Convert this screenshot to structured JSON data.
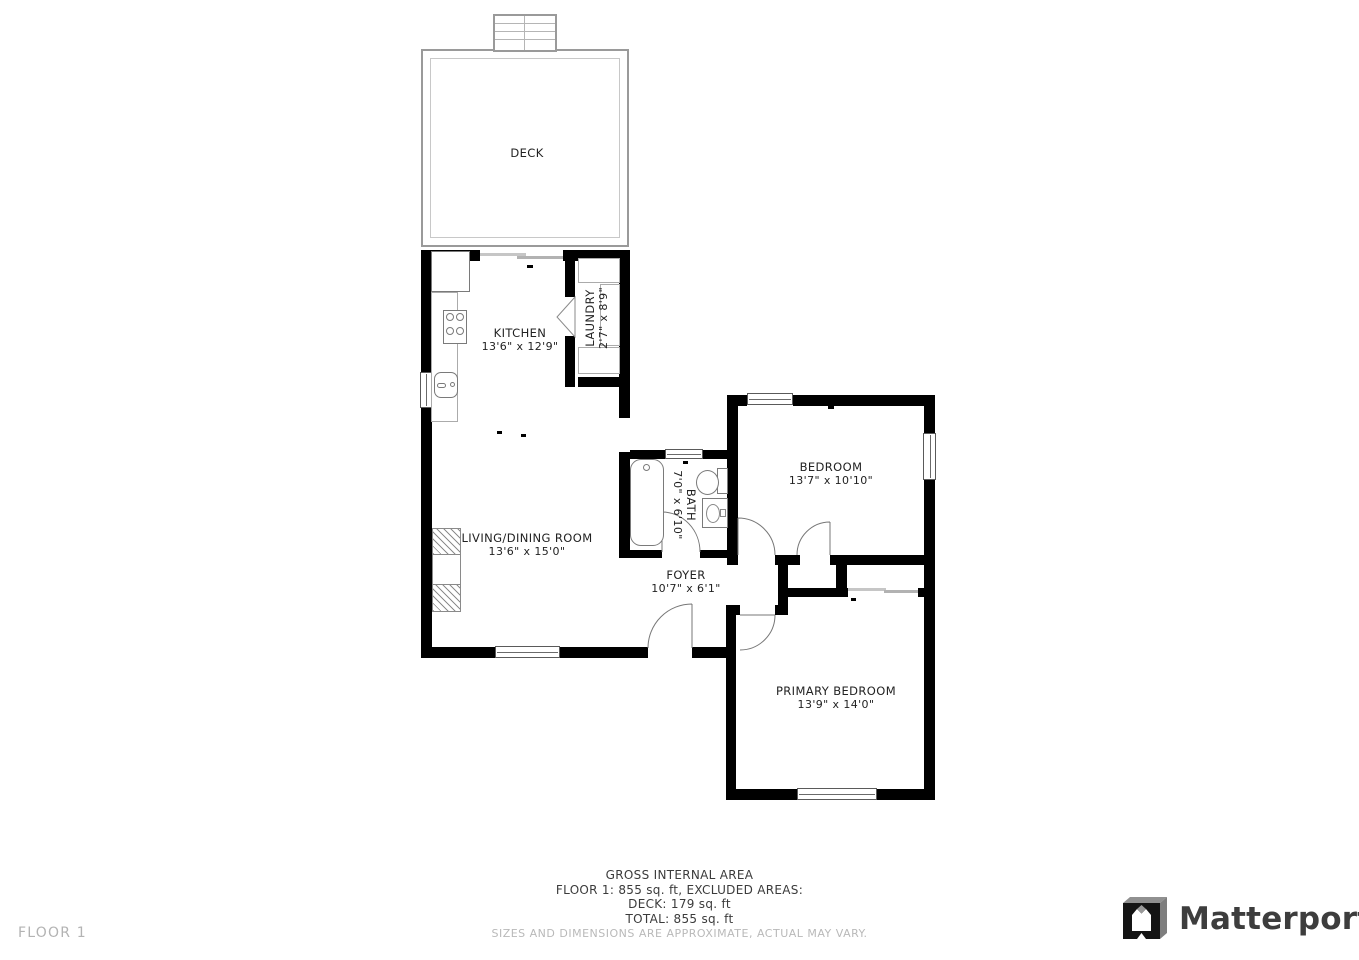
{
  "floor_label": "FLOOR 1",
  "brand": {
    "name": "Matterport"
  },
  "rooms": {
    "deck": {
      "name": "DECK"
    },
    "kitchen": {
      "name": "KITCHEN",
      "dims": "13'6\" x 12'9\""
    },
    "laundry": {
      "name": "LAUNDRY",
      "dims": "2'7\" x 8'9\""
    },
    "bath": {
      "name": "BATH",
      "dims": "7'0\" x 6'10\""
    },
    "bedroom": {
      "name": "BEDROOM",
      "dims": "13'7\" x 10'10\""
    },
    "living": {
      "name": "LIVING/DINING ROOM",
      "dims": "13'6\" x 15'0\""
    },
    "foyer": {
      "name": "FOYER",
      "dims": "10'7\" x 6'1\""
    },
    "primary": {
      "name": "PRIMARY BEDROOM",
      "dims": "13'9\" x 14'0\""
    }
  },
  "summary": {
    "title": "GROSS INTERNAL AREA",
    "line_floor": "FLOOR 1: 855 sq. ft, EXCLUDED AREAS:",
    "line_deck": "DECK: 179 sq. ft",
    "line_total": "TOTAL: 855 sq. ft",
    "disclaimer": "SIZES AND DIMENSIONS ARE APPROXIMATE, ACTUAL MAY VARY."
  }
}
